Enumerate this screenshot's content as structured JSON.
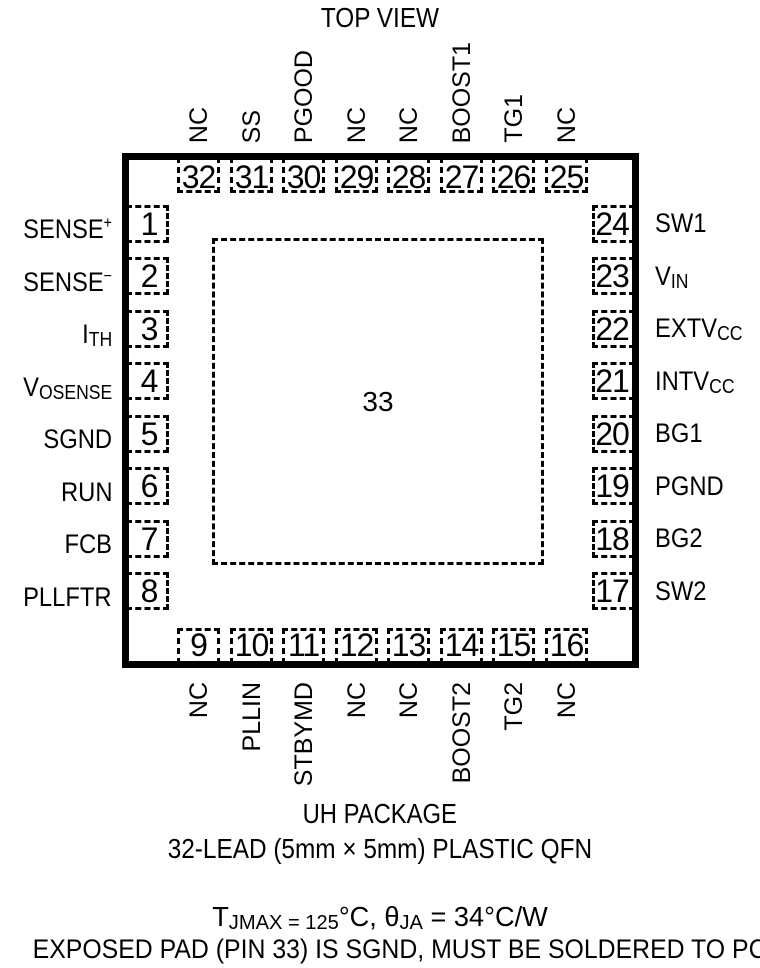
{
  "title": "TOP VIEW",
  "pins": {
    "top": [
      {
        "num": "32",
        "label": "NC"
      },
      {
        "num": "31",
        "label": "SS"
      },
      {
        "num": "30",
        "label": "PGOOD"
      },
      {
        "num": "29",
        "label": "NC"
      },
      {
        "num": "28",
        "label": "NC"
      },
      {
        "num": "27",
        "label": "BOOST1"
      },
      {
        "num": "26",
        "label": "TG1"
      },
      {
        "num": "25",
        "label": "NC"
      }
    ],
    "bottom": [
      {
        "num": "9",
        "label": "NC"
      },
      {
        "num": "10",
        "label": "PLLIN"
      },
      {
        "num": "11",
        "label": "STBYMD"
      },
      {
        "num": "12",
        "label": "NC"
      },
      {
        "num": "13",
        "label": "NC"
      },
      {
        "num": "14",
        "label": "BOOST2"
      },
      {
        "num": "15",
        "label": "TG2"
      },
      {
        "num": "16",
        "label": "NC"
      }
    ],
    "left": [
      {
        "num": "1",
        "base": "SENSE",
        "sup": "+"
      },
      {
        "num": "2",
        "base": "SENSE",
        "sup": "−"
      },
      {
        "num": "3",
        "base": "I",
        "sub": "TH"
      },
      {
        "num": "4",
        "base": "V",
        "sub": "OSENSE"
      },
      {
        "num": "5",
        "base": "SGND"
      },
      {
        "num": "6",
        "base": "RUN"
      },
      {
        "num": "7",
        "base": "FCB"
      },
      {
        "num": "8",
        "base": "PLLFTR"
      }
    ],
    "right": [
      {
        "num": "24",
        "base": "SW1"
      },
      {
        "num": "23",
        "base": "V",
        "sub": "IN"
      },
      {
        "num": "22",
        "base": "EXTV",
        "sub": "CC"
      },
      {
        "num": "21",
        "base": "INTV",
        "sub": "CC"
      },
      {
        "num": "20",
        "base": "BG1"
      },
      {
        "num": "19",
        "base": "PGND"
      },
      {
        "num": "18",
        "base": "BG2"
      },
      {
        "num": "17",
        "base": "SW2"
      }
    ]
  },
  "exposed_pad": {
    "number": "33"
  },
  "captions": {
    "package_name": "UH PACKAGE",
    "package_desc": "32-LEAD (5mm × 5mm) PLASTIC QFN",
    "thermal": {
      "t": "T",
      "t_sub": "JMAX = 125",
      "mid": "°C, θ",
      "theta_sub": "JA",
      "tail": " = 34°C/W"
    },
    "note": "EXPOSED PAD (PIN 33) IS SGND, MUST BE SOLDERED TO PCB"
  },
  "colors": {
    "ink": "#000000",
    "background": "#ffffff"
  }
}
